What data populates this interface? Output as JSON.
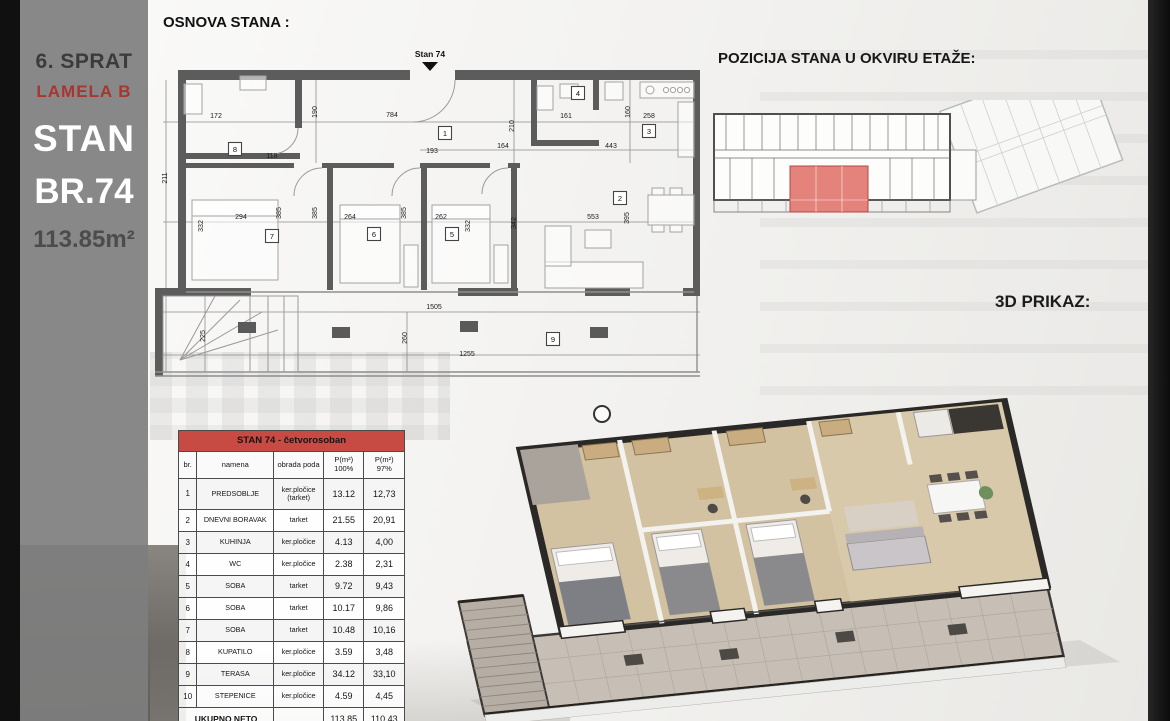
{
  "sidebar": {
    "floor_label": "6. SPRAT",
    "lamela_label": "LAMELA B",
    "stan_label": "STAN",
    "number_label": "BR.74",
    "area_label": "113.85m²"
  },
  "headings": {
    "osnova": "OSNOVA STANA :",
    "pozicija": "POZICIJA STANA U OKVIRU ETAŽE:",
    "prikaz": "3D PRIKAZ:"
  },
  "plan": {
    "unit_label": "Stan 74",
    "rooms": [
      "1",
      "2",
      "3",
      "4",
      "5",
      "6",
      "7",
      "8",
      "9"
    ],
    "dims": [
      "211",
      "172",
      "190",
      "784",
      "118",
      "193",
      "164",
      "161",
      "210",
      "443",
      "160",
      "258",
      "294",
      "332",
      "385",
      "385",
      "385",
      "264",
      "262",
      "332",
      "342",
      "553",
      "395",
      "1505",
      "260",
      "1255",
      "225"
    ]
  },
  "table": {
    "title": "STAN 74 - četvorosoban",
    "col_br": "br.",
    "col_namena": "namena",
    "col_pod": "obrada poda",
    "col_p100_1": "P(m²)",
    "col_p100_2": "100%",
    "col_p97_1": "P(m²)",
    "col_p97_2": "97%",
    "rows": [
      {
        "br": "1",
        "namena": "PREDSOBLJE",
        "pod": "ker.pločice",
        "pod2": "(tarket)",
        "p100": "13.12",
        "p97": "12,73"
      },
      {
        "br": "2",
        "namena": "DNEVNI BORAVAK",
        "pod": "tarket",
        "p100": "21.55",
        "p97": "20,91"
      },
      {
        "br": "3",
        "namena": "KUHINJA",
        "pod": "ker.pločice",
        "p100": "4.13",
        "p97": "4,00"
      },
      {
        "br": "4",
        "namena": "WC",
        "pod": "ker.pločice",
        "p100": "2.38",
        "p97": "2,31"
      },
      {
        "br": "5",
        "namena": "SOBA",
        "pod": "tarket",
        "p100": "9.72",
        "p97": "9,43"
      },
      {
        "br": "6",
        "namena": "SOBA",
        "pod": "tarket",
        "p100": "10.17",
        "p97": "9,86"
      },
      {
        "br": "7",
        "namena": "SOBA",
        "pod": "tarket",
        "p100": "10.48",
        "p97": "10,16"
      },
      {
        "br": "8",
        "namena": "KUPATILO",
        "pod": "ker.pločice",
        "p100": "3.59",
        "p97": "3,48"
      },
      {
        "br": "9",
        "namena": "TERASA",
        "pod": "ker.pločice",
        "p100": "34.12",
        "p97": "33,10"
      },
      {
        "br": "10",
        "namena": "STEPENICE",
        "pod": "ker.pločice",
        "p100": "4.59",
        "p97": "4,45"
      }
    ],
    "total_label": "UKUPNO NETO",
    "total_p100": "113,85",
    "total_p97": "110,43"
  },
  "colors": {
    "accent_red": "#c74b42",
    "unit_highlight": "#e3837b",
    "sidebar_gray": "#7e7e7e",
    "wall_gray": "#5c5c5c"
  }
}
